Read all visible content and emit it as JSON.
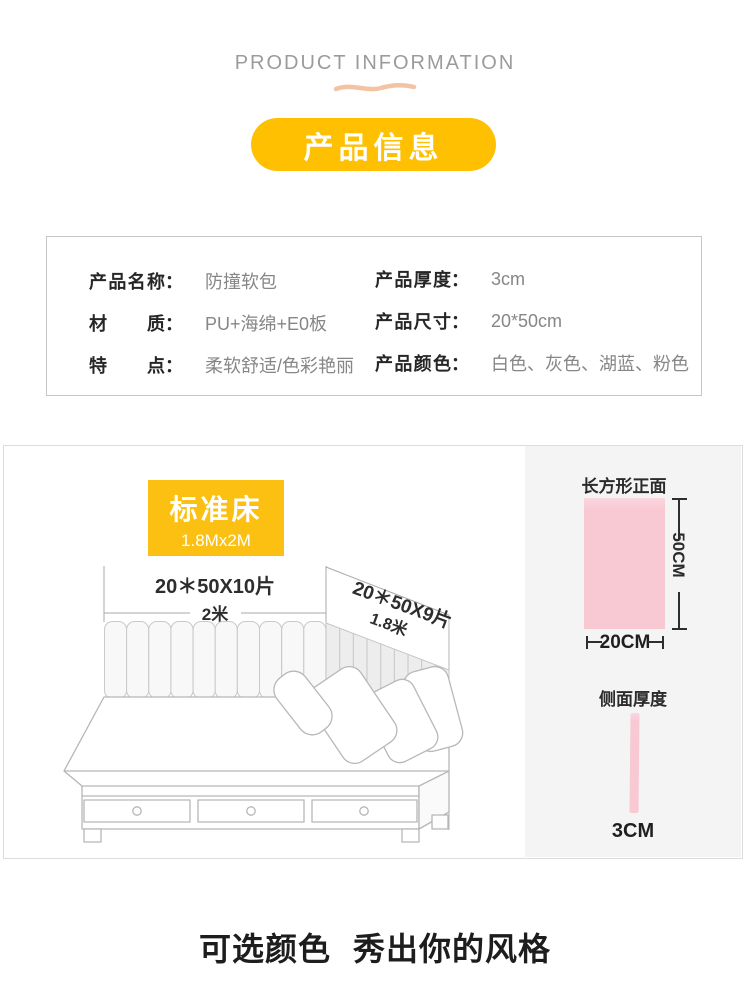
{
  "header": {
    "eyebrow": "PRODUCT INFORMATION",
    "badge": "产品信息"
  },
  "specs": {
    "colon": "：",
    "rows_left": [
      {
        "label": "产品名称",
        "value": "防撞软包"
      },
      {
        "label": "材质",
        "value": "PU+海绵+E0板"
      },
      {
        "label": "特点",
        "value": "柔软舒适/色彩艳丽"
      }
    ],
    "rows_right": [
      {
        "label": "产品厚度",
        "value": "3cm"
      },
      {
        "label": "产品尺寸",
        "value": "20*50cm"
      },
      {
        "label": "产品颜色",
        "value": "白色、灰色、湖蓝、粉色"
      }
    ]
  },
  "diagram": {
    "badge_title": "标准床",
    "badge_subtitle": "1.8Mx2M",
    "back_wall_label": "20＊50X10片",
    "back_wall_length": "2米",
    "side_wall_label": "20＊50X9片",
    "side_wall_length": "1.8米",
    "front_view": {
      "title": "长方形正面",
      "height_label": "50CM",
      "width_label": "20CM"
    },
    "side_view": {
      "title": "侧面厚度",
      "thickness_label": "3CM"
    }
  },
  "footer": {
    "headline": "可选颜色 秀出你的风格"
  },
  "colors": {
    "accent_yellow": "#FFC002",
    "badge_yellow": "#FBC012",
    "pink": "#F8C8D3",
    "wave_peach": "#F3C3A4"
  }
}
